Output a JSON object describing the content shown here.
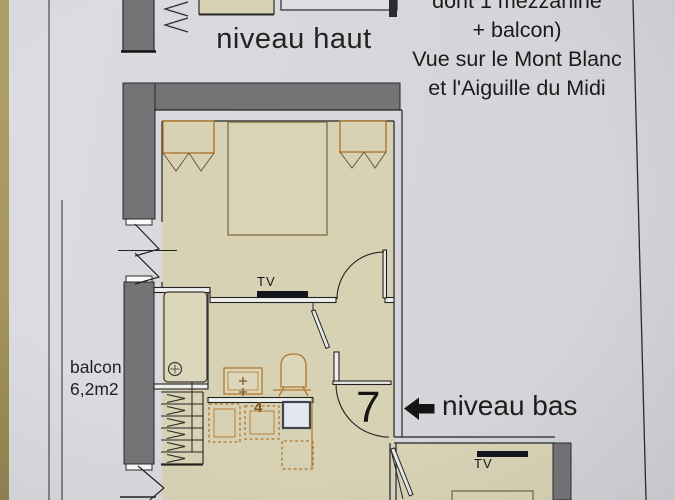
{
  "document": {
    "kind": "apartment floor plan photo",
    "notes": {
      "line1": "dont 1 mezzanine",
      "line2": "+ balcon)",
      "line3": "Vue sur le Mont Blanc",
      "line4": "et l'Aiguille du Midi"
    },
    "levels": {
      "upper_label": "niveau haut",
      "lower_label": "niveau bas",
      "unit_number": "7"
    },
    "balcony": {
      "name": "balcon",
      "area": "6,2m2"
    },
    "room_labels": {
      "tv_bedroom": "TV",
      "tv_lower_room": "TV",
      "appliance_number": "4"
    }
  },
  "colors": {
    "paper": "#d7d8dc",
    "wall_gray": "#747477",
    "floor_beige": "#d8d2b5",
    "furniture_orange": "#b2772c",
    "ink_black": "#222222",
    "tv_marker": "#14141c",
    "table_edge_tan": "#a6955e",
    "appliance_blue_white": "#e3e7ee"
  }
}
